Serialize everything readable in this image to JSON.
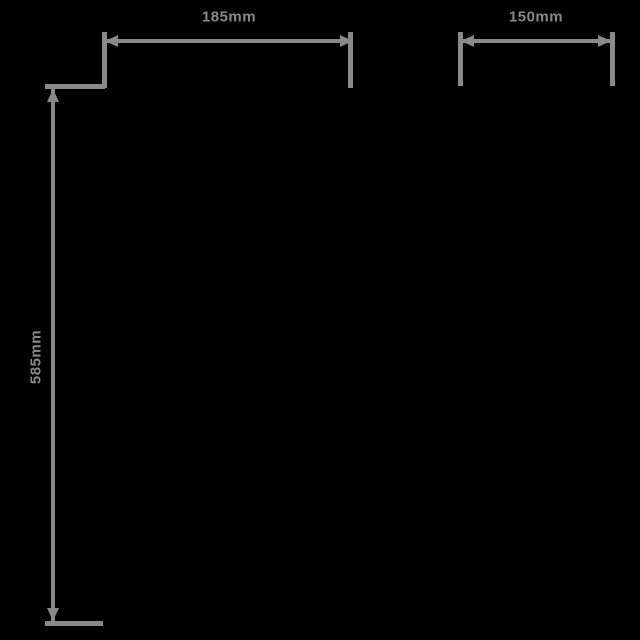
{
  "diagram": {
    "background_color": "#000000",
    "line_color": "#898989",
    "unit": "mm",
    "dimensions": {
      "top_width": {
        "label": "185mm",
        "value": 185
      },
      "top_right_width": {
        "label": "150mm",
        "value": 150
      },
      "left_height": {
        "label": "585mm",
        "value": 585
      }
    }
  }
}
